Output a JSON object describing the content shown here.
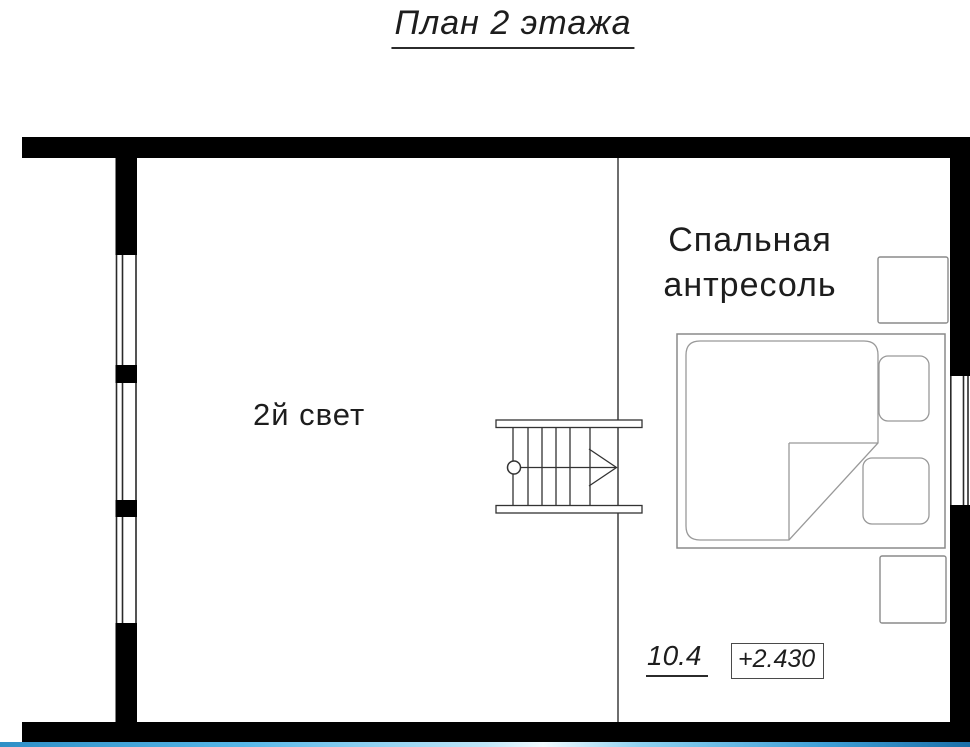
{
  "title": "План 2 этажа",
  "rooms": {
    "double_height": {
      "label": "2й свет"
    },
    "bedroom": {
      "label": "Спальная антресоль",
      "area": "10.4",
      "elevation": "+2.430"
    }
  },
  "colors": {
    "wall": "#000000",
    "thin_line": "#3f3f3f",
    "furniture_line": "#999999",
    "accent_bar_blue": "#47a9dc"
  }
}
